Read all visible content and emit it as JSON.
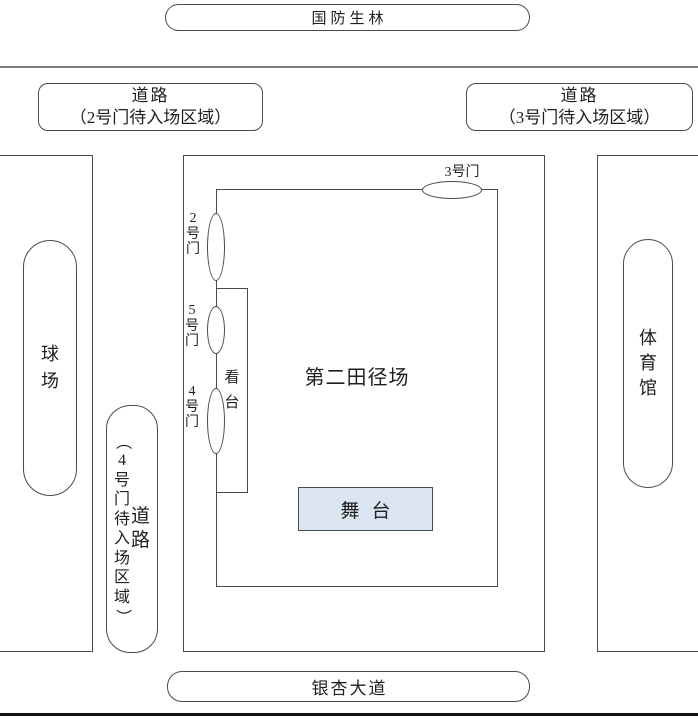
{
  "areas": {
    "forest": {
      "label": "国防生林"
    },
    "road_gate2": {
      "line1": "道路",
      "line2": "（2号门待入场区域）"
    },
    "road_gate3": {
      "line1": "道路",
      "line2": "（3号门待入场区域）"
    },
    "ball_field": {
      "label": "球场"
    },
    "road_gate4": {
      "main": "道路",
      "paren": "（4号门待入场区域）"
    },
    "gym": {
      "label": "体育馆"
    },
    "track_field": {
      "label": "第二田径场"
    },
    "stand": {
      "label": "看台"
    },
    "stage": {
      "label": "舞台"
    },
    "avenue": {
      "label": "银杏大道"
    }
  },
  "gates": {
    "gate2": {
      "label": "2号门"
    },
    "gate3": {
      "label": "3号门"
    },
    "gate4": {
      "label": "4号门"
    },
    "gate5": {
      "label": "5号门"
    }
  },
  "colors": {
    "outline": "#4b4b4b",
    "stage_fill": "#dbe5f1",
    "divider_top": "#7d7d7d",
    "divider_bottom": "#141414"
  }
}
